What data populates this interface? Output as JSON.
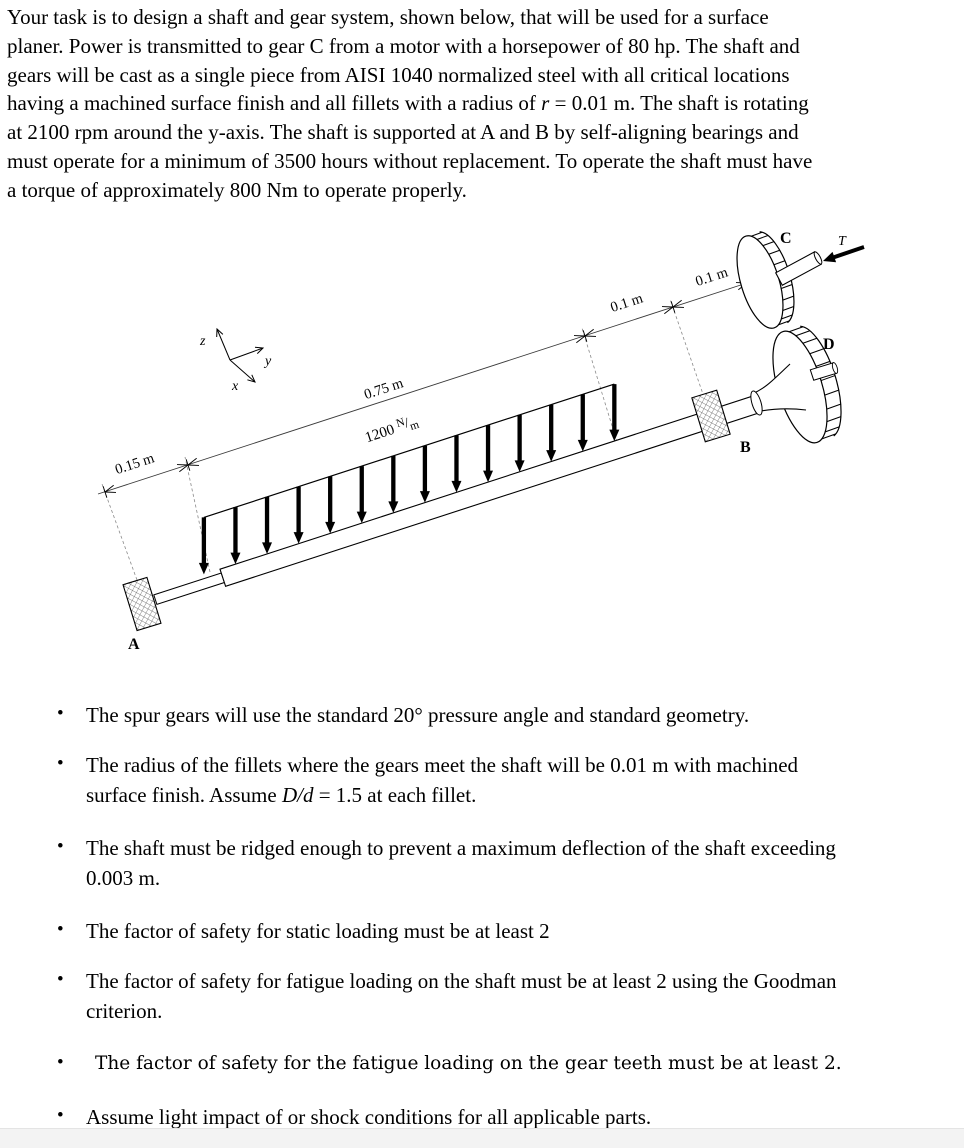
{
  "intro": {
    "lines": [
      [
        {
          "t": "Your task is to design a shaft and gear system, shown below, that will be used for a surface"
        }
      ],
      [
        {
          "t": "planer. Power is transmitted to gear C from a motor with a horsepower of 80 hp. The shaft and"
        }
      ],
      [
        {
          "t": "gears will be cast as a single piece from AISI 1040 normalized steel with all critical locations"
        }
      ],
      [
        {
          "t": "having a machined surface finish and all fillets with a radius of "
        },
        {
          "t": "r",
          "i": 1
        },
        {
          "t": " = 0.01 m. The shaft is rotating"
        }
      ],
      [
        {
          "t": "at 2100 rpm around the y-axis. The shaft is supported at A and B by self-aligning bearings and"
        }
      ],
      [
        {
          "t": "must operate for a minimum of 3500 hours without replacement. To operate the shaft must have"
        }
      ],
      [
        {
          "t": "a torque of approximately 800 Nm to operate properly."
        }
      ]
    ]
  },
  "bullets": [
    {
      "alt": false,
      "lines": [
        [
          {
            "t": "The spur gears will use the standard 20° pressure angle and standard geometry."
          }
        ]
      ]
    },
    {
      "alt": false,
      "lines": [
        [
          {
            "t": "The radius of the fillets where the gears meet the shaft will be 0.01 m with machined"
          }
        ],
        [
          {
            "t": "surface finish. Assume "
          },
          {
            "t": "D/d",
            "i": 1
          },
          {
            "t": " = 1.5 at each fillet."
          }
        ]
      ]
    },
    {
      "alt": false,
      "lines": [
        [
          {
            "t": "The shaft must be ridged enough to prevent a maximum deflection of the shaft exceeding"
          }
        ],
        [
          {
            "t": "0.003 m."
          }
        ]
      ]
    },
    {
      "alt": false,
      "lines": [
        [
          {
            "t": "The factor of safety for static loading must be at least 2"
          }
        ]
      ]
    },
    {
      "alt": false,
      "lines": [
        [
          {
            "t": "The factor of safety for fatigue loading on the shaft must be at least 2 using the Goodman"
          }
        ],
        [
          {
            "t": "criterion."
          }
        ]
      ]
    },
    {
      "alt": true,
      "lines": [
        [
          {
            "t": "The factor of safety for the fatigue loading on the gear teeth must be at least 2."
          }
        ]
      ]
    },
    {
      "alt": false,
      "lines": [
        [
          {
            "t": "Assume light impact of or shock conditions for all applicable parts."
          }
        ]
      ]
    }
  ],
  "diagram": {
    "axes": {
      "x": "x",
      "y": "y",
      "z": "z"
    },
    "dims": {
      "left": "0.15 m",
      "load_span": "0.75 m",
      "seg_b": "0.1 m",
      "seg_c": "0.1 m"
    },
    "load": {
      "value": "1200",
      "unit_numerator": "N",
      "unit_denominator": "m"
    },
    "labels": {
      "bearing_a": "A",
      "bearing_b": "B",
      "gear_c": "C",
      "gear_d": "D",
      "torque": "T"
    }
  }
}
